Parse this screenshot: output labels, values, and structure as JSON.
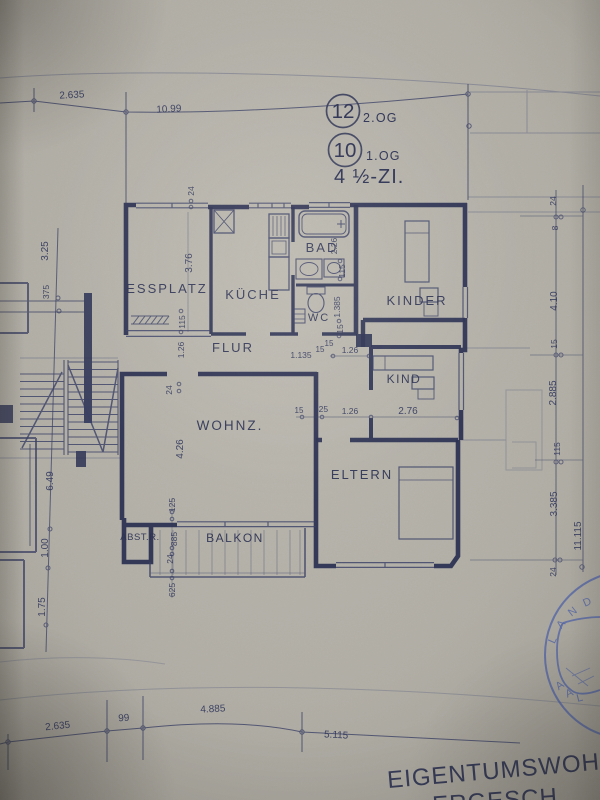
{
  "header": {
    "unit_upper_number": "12",
    "unit_upper_floor": "2.OG",
    "unit_lower_number": "10",
    "unit_lower_floor": "1.OG",
    "apartment_type": "4 ½-ZI."
  },
  "rooms": {
    "essplatz": "ESSPLATZ",
    "kueche": "KÜCHE",
    "bad": "BAD",
    "wc": "WC",
    "flur": "FLUR",
    "kinder": "KINDER",
    "kind": "KIND",
    "wohnz": "WOHNZ.",
    "eltern": "ELTERN",
    "abstr": "ABST.R.",
    "balkon": "BALKON"
  },
  "dims": {
    "top": {
      "d1": "2.635",
      "d2": "10.99"
    },
    "bottom": {
      "d1": "2.635",
      "d2": "99",
      "d3": "4.885",
      "d4": "5.115"
    },
    "left": {
      "d1": "3.25",
      "d2": "375",
      "d3": "6.49",
      "d4": "1.00",
      "d5": "1.75"
    },
    "right": {
      "d1": "24",
      "d2": "8",
      "d3": "4.10",
      "d4": "15",
      "d5": "2.885",
      "d6": "115",
      "d7": "3.385",
      "d8": "24",
      "total": "11.115"
    },
    "inner": {
      "v376": "3.76",
      "v24top": "24",
      "v115flur": "115",
      "v126flur": "1.26",
      "v24flur": "24",
      "v426": "4.26",
      "v226": "2.26",
      "v115bad": "115",
      "v1385": "1.385",
      "v15bad": "15",
      "h1135": "1.135",
      "h15wc": "15",
      "h15wc2": "15",
      "h126kind": "1.26",
      "h15elt": "15",
      "h625elt": "625",
      "h126elt": "1.26",
      "h276": "2.76",
      "v125bal": "125",
      "v885bal": "885",
      "v24bal": "24",
      "v625bal": "625"
    }
  },
  "title_block": {
    "line1": "EIGENTUMSWOHN",
    "line2": "ERGESCH"
  },
  "stamp": {
    "top_letters": [
      "L",
      "A",
      "N",
      "D"
    ],
    "bottom_letters": [
      "A",
      "A",
      "L"
    ]
  },
  "colors": {
    "paper": "#b3b0a8",
    "ink": "#2e3354",
    "ink_light": "#4a5174",
    "stamp_blue": "#5264a6"
  }
}
